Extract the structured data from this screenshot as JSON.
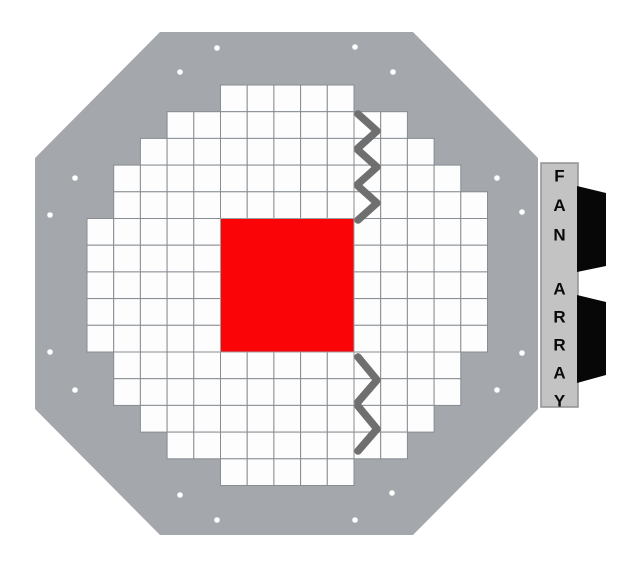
{
  "scene": {
    "canvas": {
      "width": 636,
      "height": 575,
      "background": "#ffffff"
    },
    "plate": {
      "color": "#a4a7ab",
      "vertices": [
        [
          160,
          32
        ],
        [
          413,
          32
        ],
        [
          538,
          158
        ],
        [
          538,
          409
        ],
        [
          413,
          535
        ],
        [
          160,
          535
        ],
        [
          35,
          409
        ],
        [
          35,
          158
        ]
      ]
    },
    "screw_holes": {
      "color": "#ffffff",
      "radius": 2.8,
      "positions": [
        [
          217,
          48
        ],
        [
          355,
          47
        ],
        [
          180,
          72
        ],
        [
          393,
          72
        ],
        [
          75,
          178
        ],
        [
          497,
          178
        ],
        [
          50,
          215
        ],
        [
          522,
          212
        ],
        [
          50,
          352
        ],
        [
          522,
          353
        ],
        [
          75,
          390
        ],
        [
          497,
          390
        ],
        [
          180,
          495
        ],
        [
          392,
          493
        ],
        [
          217,
          520
        ],
        [
          355,
          520
        ]
      ]
    },
    "grid": {
      "origin_x": 87,
      "origin_y": 85,
      "cell_size": 26.7,
      "rows": 15,
      "cols": 15,
      "line_color": "#878d93",
      "cell_color": "#fdfdfd",
      "row_spans": [
        [
          5,
          9
        ],
        [
          3,
          11
        ],
        [
          2,
          12
        ],
        [
          1,
          13
        ],
        [
          1,
          14
        ],
        [
          0,
          14
        ],
        [
          0,
          14
        ],
        [
          0,
          14
        ],
        [
          0,
          14
        ],
        [
          0,
          14
        ],
        [
          1,
          13
        ],
        [
          1,
          13
        ],
        [
          2,
          12
        ],
        [
          3,
          11
        ],
        [
          5,
          9
        ]
      ]
    },
    "center_block": {
      "color": "#fb0408",
      "border_color": "#9aa0a6",
      "col_start": 5,
      "row_start": 5,
      "col_span": 5,
      "row_span": 5
    },
    "chevrons": {
      "color": "#6f6f6f",
      "stroke_width": 7.5,
      "groups": [
        {
          "name": "top",
          "polylines": [
            [
              [
                358,
                114
              ],
              [
                377,
                131
              ],
              [
                358,
                148
              ]
            ],
            [
              [
                358,
                150
              ],
              [
                377,
                167
              ],
              [
                358,
                184
              ]
            ],
            [
              [
                358,
                186
              ],
              [
                377,
                203
              ],
              [
                358,
                220
              ]
            ]
          ]
        },
        {
          "name": "bottom",
          "polylines": [
            [
              [
                358,
                357
              ],
              [
                377,
                380
              ],
              [
                358,
                402
              ]
            ],
            [
              [
                358,
                406
              ],
              [
                377,
                429
              ],
              [
                358,
                451
              ]
            ]
          ]
        }
      ]
    },
    "fan_bar": {
      "x": 541,
      "y": 163,
      "width": 37,
      "height": 244,
      "fill": "#c3c3c4",
      "border_color": "#8f9194",
      "label": "FAN ARRAY",
      "label_color": "#0a0a0a",
      "font_size": 17,
      "center_x": 559.5,
      "words": [
        {
          "text": "FAN",
          "start_y": 176,
          "step": 29.5
        },
        {
          "text": "ARRAY",
          "start_y": 289,
          "step": 28
        }
      ]
    },
    "fans": {
      "color": "#070707",
      "polygons": [
        [
          [
            577,
            186
          ],
          [
            606,
            193
          ],
          [
            606,
            266
          ],
          [
            577,
            272
          ]
        ],
        [
          [
            577,
            295
          ],
          [
            606,
            302
          ],
          [
            606,
            375
          ],
          [
            577,
            383
          ]
        ]
      ]
    }
  }
}
